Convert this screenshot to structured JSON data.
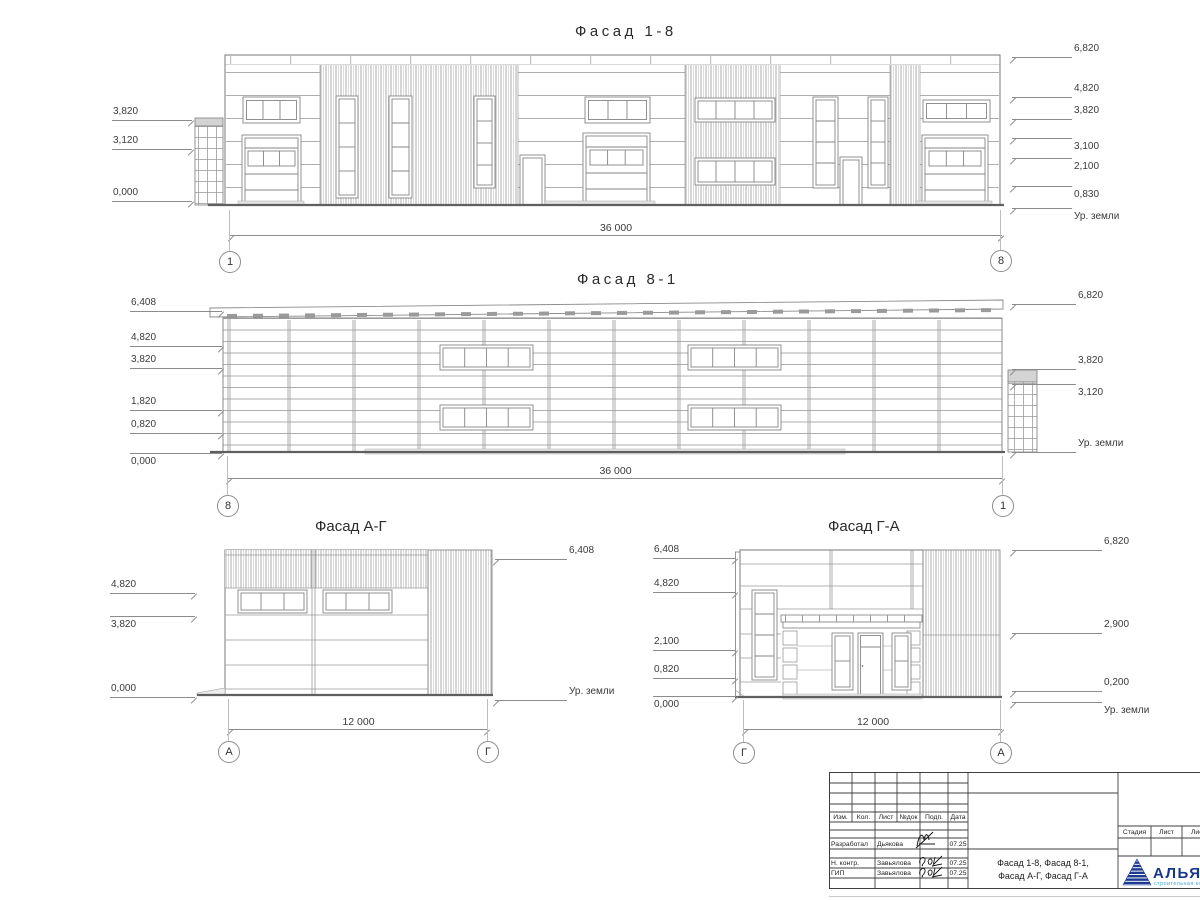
{
  "facades": {
    "f18": {
      "title": "Фасад 1-8",
      "left": [
        "3,820",
        "3,120",
        "0,000"
      ],
      "right": [
        "6,820",
        "4,820",
        "3,820",
        "3,100",
        "2,100",
        "0,830"
      ],
      "ground": "Ур. земли",
      "width_dim": "36 000",
      "axis_left": "1",
      "axis_right": "8"
    },
    "f81": {
      "title": "Фасад 8-1",
      "left": [
        "6,408",
        "4,820",
        "3,820",
        "1,820",
        "0,820",
        "0,000"
      ],
      "right": [
        "6,820",
        "3,820",
        "3,120"
      ],
      "ground": "Ур. земли",
      "width_dim": "36 000",
      "axis_left": "8",
      "axis_right": "1"
    },
    "fag": {
      "title": "Фасад А-Г",
      "left": [
        "4,820",
        "3,820",
        "0,000"
      ],
      "right": [
        "6,408"
      ],
      "ground": "Ур. земли",
      "width_dim": "12 000",
      "axis_left": "А",
      "axis_right": "Г"
    },
    "fga": {
      "title": "Фасад Г-А",
      "left": [
        "6,408",
        "4,820",
        "2,100",
        "0,820",
        "0,000"
      ],
      "right": [
        "6,820",
        "2,900",
        "0,200"
      ],
      "ground": "Ур. земли",
      "width_dim": "12 000",
      "axis_left": "Г",
      "axis_right": "А"
    }
  },
  "title_block": {
    "change_cols": [
      "Изм.",
      "Кол.",
      "Лист",
      "№док",
      "Подп.",
      "Дата"
    ],
    "rows": [
      {
        "role": "Разработал",
        "name": "Дьякова",
        "date": "07.25"
      },
      {
        "role": "Н. контр.",
        "name": "Завьялова",
        "date": "07.25"
      },
      {
        "role": "ГИП",
        "name": "Завьялова",
        "date": "07.25"
      }
    ],
    "title_line1": "Фасад 1-8, Фасад 8-1,",
    "title_line2": "Фасад А-Г, Фасад Г-А",
    "stage_cols": [
      "Стадия",
      "Лист",
      "Листов"
    ],
    "logo_name": "АЛЬЯНС",
    "logo_sub": "строительная компания",
    "logo_color": "#17378e",
    "logo_sub_color": "#41a6d9"
  }
}
